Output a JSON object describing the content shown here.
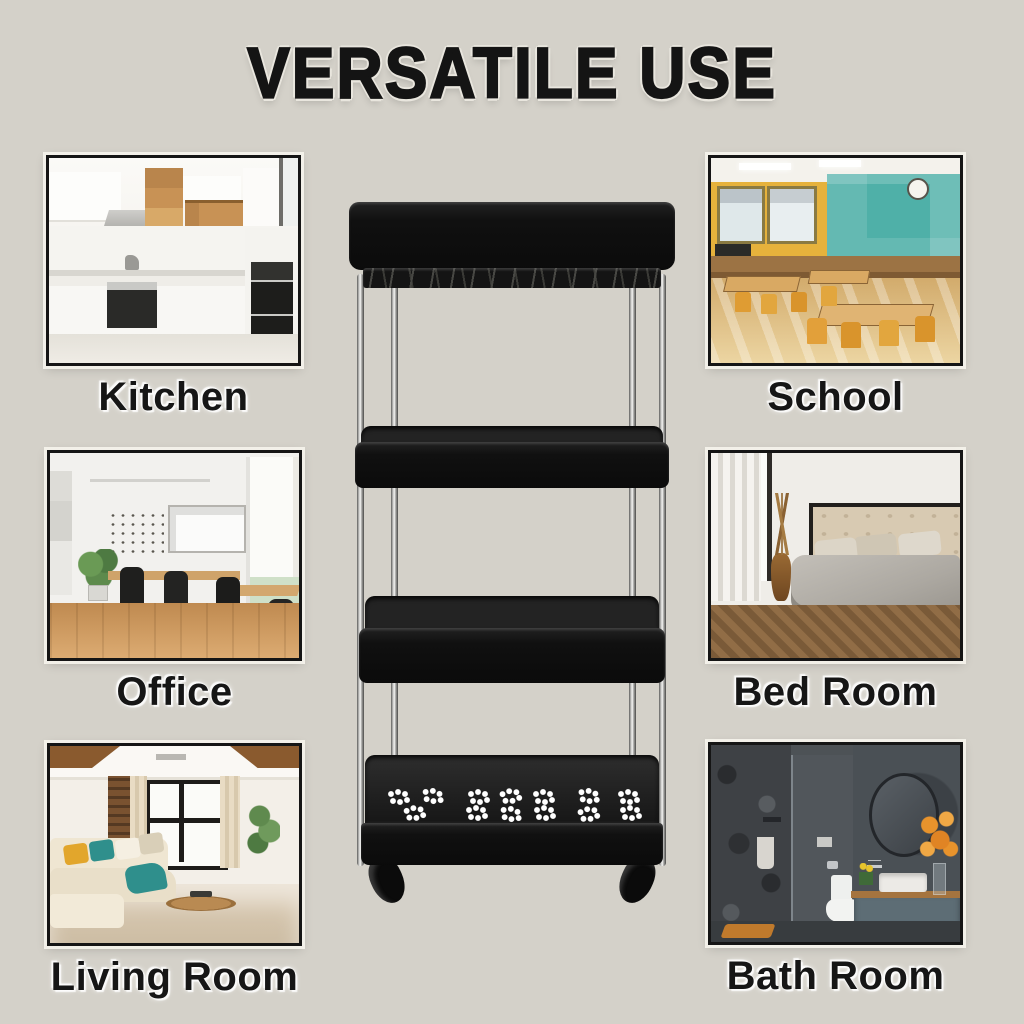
{
  "title": "VERSATILE USE",
  "colors": {
    "background": "#d4d1c9",
    "title_text": "#141414",
    "title_halo": "#e9e6de",
    "frame_border": "#151515",
    "frame_halo": "#f4f2eb",
    "label_text": "#161616",
    "cart_basket": "#0e0e0e",
    "cart_pole_chrome": "#c9c9c7",
    "paw_cutout": "#ffffff"
  },
  "rooms": [
    {
      "id": "kitchen",
      "label": "Kitchen"
    },
    {
      "id": "school",
      "label": "School"
    },
    {
      "id": "office",
      "label": "Office"
    },
    {
      "id": "bedroom",
      "label": "Bed Room"
    },
    {
      "id": "living-room",
      "label": "Living Room"
    },
    {
      "id": "bathroom",
      "label": "Bath Room"
    }
  ],
  "product": {
    "name": "four-tier-slim-rolling-storage-cart",
    "tiers": 4
  }
}
